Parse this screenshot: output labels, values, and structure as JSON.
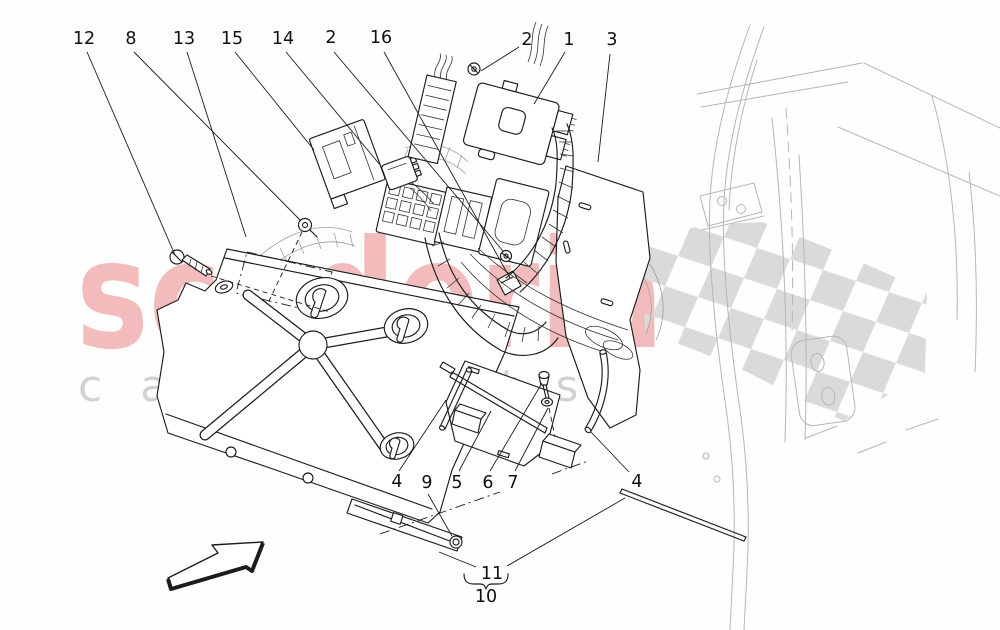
{
  "watermark": {
    "brand": "scuderia",
    "tagline": "car parts"
  },
  "colors": {
    "brand_pink": "#f2bcbc",
    "tagline_gray": "#d2d2d2",
    "flag_gray": "#dadada",
    "line_dark": "#1c1c1c",
    "line_light": "#b6b6b6"
  },
  "callouts": [
    {
      "label": "12"
    },
    {
      "label": "8"
    },
    {
      "label": "13"
    },
    {
      "label": "15"
    },
    {
      "label": "14"
    },
    {
      "label": "2"
    },
    {
      "label": "16"
    },
    {
      "label": "2"
    },
    {
      "label": "1"
    },
    {
      "label": "3"
    },
    {
      "label": "4"
    },
    {
      "label": "9"
    },
    {
      "label": "5"
    },
    {
      "label": "6"
    },
    {
      "label": "7"
    },
    {
      "label": "4"
    },
    {
      "label": "11"
    },
    {
      "label": "10"
    }
  ]
}
